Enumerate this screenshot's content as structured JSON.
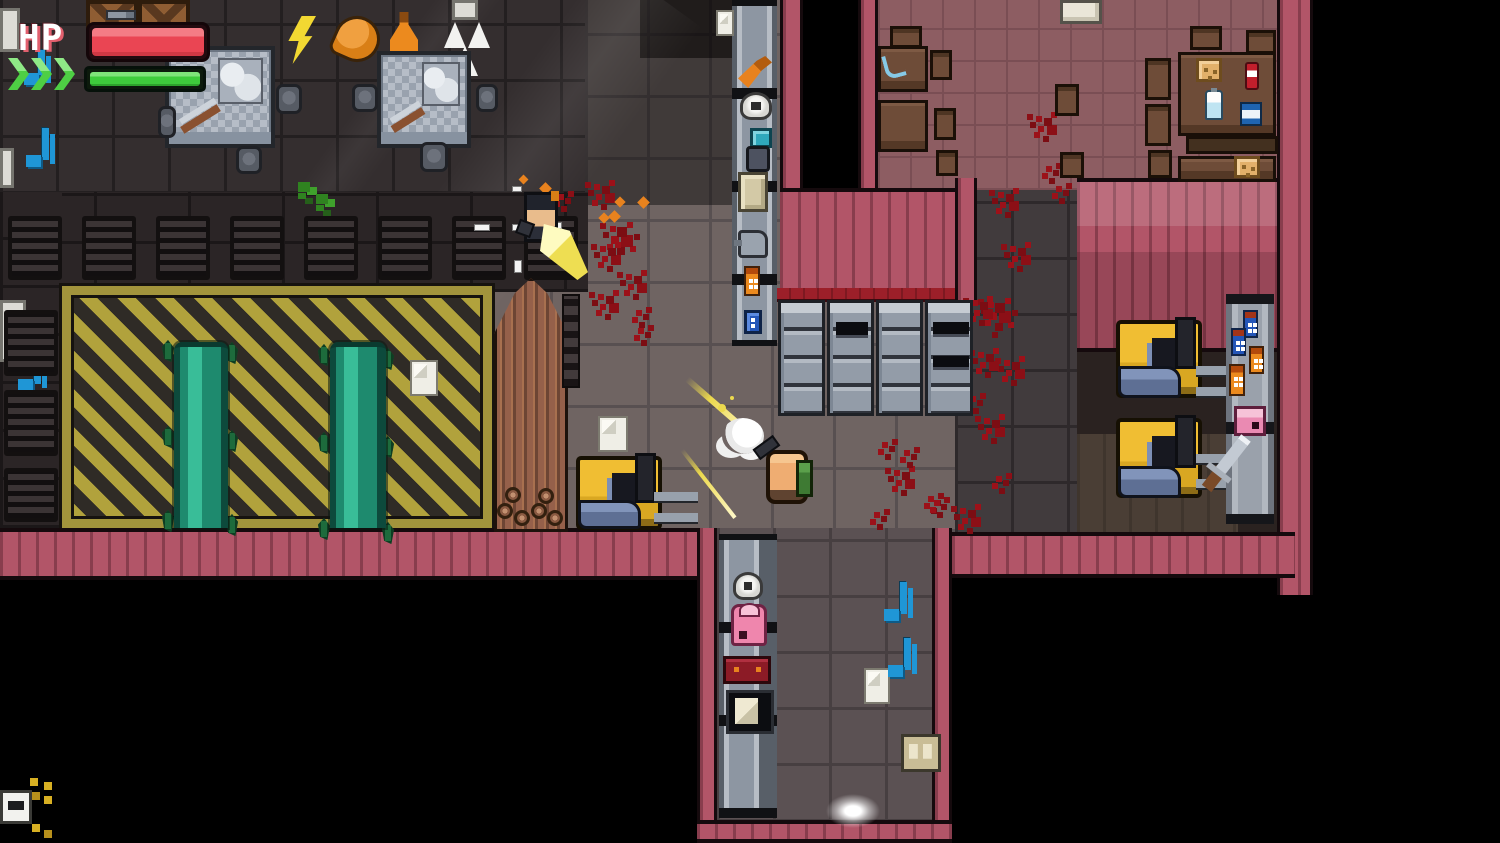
{
  "hud": {
    "hp_label": "HP",
    "hp_percent": 100,
    "boost_percent": 100,
    "chevron_count": 3,
    "hp_color": "#ea4553",
    "boost_color": "#3ecb3c"
  },
  "palette": {
    "wall_pink": "#b25568",
    "hazard_yellow": "#b1a23c",
    "floor_warehouse": "#6f6462",
    "floor_factory": "#342e2f",
    "floor_cafeteria": "#8d5d62",
    "conveyor_teal": "#1e8a6e",
    "forklift_yellow": "#f0be33",
    "blood_red": "#9c1119",
    "void_black": "#000000"
  },
  "scene": {
    "entities": [
      {
        "t": "crate",
        "x": 86,
        "y": 0,
        "w": 52,
        "h": 42
      },
      {
        "t": "crate",
        "x": 138,
        "y": 0,
        "w": 52,
        "h": 42
      },
      {
        "t": "whitepart",
        "x": 0,
        "y": 8,
        "w": 20,
        "h": 44
      },
      {
        "t": "whitepart",
        "x": 0,
        "y": 148,
        "w": 14,
        "h": 40
      },
      {
        "t": "whitepart",
        "x": 0,
        "y": 300,
        "w": 26,
        "h": 62
      },
      {
        "t": "whitepart",
        "x": 452,
        "y": 0,
        "w": 26,
        "h": 20
      },
      {
        "t": "lightning",
        "x": 286,
        "y": 16,
        "w": 30,
        "h": 48
      },
      {
        "t": "drumstick",
        "x": 334,
        "y": 16,
        "w": 46,
        "h": 46,
        "r": 24
      },
      {
        "t": "flask",
        "x": 390,
        "y": 12,
        "w": 28,
        "h": 48
      },
      {
        "t": "tri-white",
        "x": 444,
        "y": 22,
        "w": 22,
        "h": 26
      },
      {
        "t": "tri-white",
        "x": 468,
        "y": 22,
        "w": 22,
        "h": 26
      },
      {
        "t": "tri-white",
        "x": 452,
        "y": 46,
        "w": 26,
        "h": 30
      },
      {
        "t": "bench",
        "x": 165,
        "y": 46,
        "w": 110,
        "h": 102
      },
      {
        "t": "bench",
        "x": 377,
        "y": 51,
        "w": 94,
        "h": 97
      },
      {
        "t": "stool",
        "x": 276,
        "y": 84,
        "w": 26,
        "h": 30
      },
      {
        "t": "stool",
        "x": 236,
        "y": 146,
        "w": 26,
        "h": 28
      },
      {
        "t": "stool",
        "x": 352,
        "y": 84,
        "w": 26,
        "h": 28
      },
      {
        "t": "stool",
        "x": 420,
        "y": 142,
        "w": 28,
        "h": 30
      },
      {
        "t": "stool",
        "x": 476,
        "y": 84,
        "w": 22,
        "h": 28
      },
      {
        "t": "stool",
        "x": 158,
        "y": 106,
        "w": 18,
        "h": 32
      },
      {
        "t": "green-slime",
        "x": 298,
        "y": 182,
        "w": 12,
        "h": 10
      },
      {
        "t": "green-slime",
        "x": 316,
        "y": 194,
        "w": 12,
        "h": 10
      },
      {
        "t": "paper",
        "x": 716,
        "y": 10,
        "w": 18,
        "h": 26
      },
      {
        "t": "music-note",
        "x": 26,
        "y": 128,
        "w": 26,
        "h": 44
      },
      {
        "t": "music-note",
        "x": 18,
        "y": 352,
        "w": 26,
        "h": 44
      },
      {
        "t": "music-note",
        "x": 24,
        "y": 50,
        "w": 24,
        "h": 40
      },
      {
        "t": "vent",
        "x": 8,
        "y": 216,
        "w": 54,
        "h": 64
      },
      {
        "t": "vent",
        "x": 82,
        "y": 216,
        "w": 54,
        "h": 64
      },
      {
        "t": "vent",
        "x": 156,
        "y": 216,
        "w": 54,
        "h": 64
      },
      {
        "t": "vent",
        "x": 230,
        "y": 216,
        "w": 54,
        "h": 64
      },
      {
        "t": "vent",
        "x": 304,
        "y": 216,
        "w": 54,
        "h": 64
      },
      {
        "t": "vent",
        "x": 378,
        "y": 216,
        "w": 54,
        "h": 64
      },
      {
        "t": "vent",
        "x": 452,
        "y": 216,
        "w": 54,
        "h": 64
      },
      {
        "t": "vent",
        "x": 524,
        "y": 216,
        "w": 54,
        "h": 64
      },
      {
        "t": "vent",
        "x": 4,
        "y": 310,
        "w": 54,
        "h": 66
      },
      {
        "t": "vent",
        "x": 4,
        "y": 390,
        "w": 54,
        "h": 66
      },
      {
        "t": "vent",
        "x": 4,
        "y": 468,
        "w": 54,
        "h": 54
      },
      {
        "t": "sprout",
        "x": 162,
        "y": 340,
        "w": 12,
        "h": 22
      },
      {
        "t": "sprout",
        "x": 162,
        "y": 426,
        "w": 12,
        "h": 22
      },
      {
        "t": "sprout",
        "x": 162,
        "y": 510,
        "w": 12,
        "h": 22
      },
      {
        "t": "sprout",
        "x": 226,
        "y": 342,
        "w": 12,
        "h": 22
      },
      {
        "t": "sprout",
        "x": 226,
        "y": 430,
        "w": 12,
        "h": 22
      },
      {
        "t": "sprout",
        "x": 226,
        "y": 514,
        "w": 12,
        "h": 22
      },
      {
        "t": "sprout",
        "x": 318,
        "y": 344,
        "w": 12,
        "h": 22
      },
      {
        "t": "sprout",
        "x": 318,
        "y": 432,
        "w": 12,
        "h": 22
      },
      {
        "t": "sprout",
        "x": 318,
        "y": 518,
        "w": 12,
        "h": 22
      },
      {
        "t": "sprout",
        "x": 382,
        "y": 348,
        "w": 12,
        "h": 22
      },
      {
        "t": "sprout",
        "x": 382,
        "y": 436,
        "w": 12,
        "h": 22
      },
      {
        "t": "sprout",
        "x": 382,
        "y": 522,
        "w": 12,
        "h": 22
      },
      {
        "t": "conveyor-teal",
        "x": 174,
        "y": 342,
        "w": 54,
        "h": 186
      },
      {
        "t": "conveyor-teal",
        "x": 330,
        "y": 342,
        "w": 56,
        "h": 186
      },
      {
        "t": "paper",
        "x": 410,
        "y": 360,
        "w": 28,
        "h": 36
      },
      {
        "t": "woodpile",
        "x": 494,
        "y": 278,
        "w": 74,
        "h": 254
      },
      {
        "t": "ladder",
        "x": 562,
        "y": 294,
        "w": 18,
        "h": 94
      },
      {
        "t": "logend",
        "x": 497,
        "y": 503,
        "w": 16,
        "h": 16
      },
      {
        "t": "logend",
        "x": 514,
        "y": 510,
        "w": 16,
        "h": 16
      },
      {
        "t": "logend",
        "x": 531,
        "y": 503,
        "w": 16,
        "h": 16
      },
      {
        "t": "logend",
        "x": 547,
        "y": 510,
        "w": 16,
        "h": 16
      },
      {
        "t": "logend",
        "x": 505,
        "y": 487,
        "w": 16,
        "h": 16
      },
      {
        "t": "logend",
        "x": 538,
        "y": 488,
        "w": 16,
        "h": 16
      },
      {
        "t": "paper",
        "x": 598,
        "y": 416,
        "w": 30,
        "h": 36
      },
      {
        "t": "blood-m",
        "x": 594,
        "y": 184,
        "w": 6,
        "h": 6
      },
      {
        "t": "blood-l",
        "x": 610,
        "y": 226,
        "w": 6,
        "h": 6
      },
      {
        "t": "blood-m",
        "x": 600,
        "y": 246,
        "w": 6,
        "h": 6
      },
      {
        "t": "blood-m",
        "x": 626,
        "y": 274,
        "w": 6,
        "h": 6
      },
      {
        "t": "blood-s",
        "x": 636,
        "y": 310,
        "w": 6,
        "h": 6
      },
      {
        "t": "blood-s",
        "x": 558,
        "y": 194,
        "w": 6,
        "h": 6
      },
      {
        "t": "blood-m",
        "x": 598,
        "y": 294,
        "w": 6,
        "h": 6
      },
      {
        "t": "blood-s",
        "x": 638,
        "y": 328,
        "w": 6,
        "h": 6
      },
      {
        "t": "blood-m",
        "x": 998,
        "y": 192,
        "w": 6,
        "h": 6
      },
      {
        "t": "blood-m",
        "x": 1010,
        "y": 246,
        "w": 6,
        "h": 6
      },
      {
        "t": "blood-l",
        "x": 988,
        "y": 302,
        "w": 6,
        "h": 6
      },
      {
        "t": "blood-m",
        "x": 1004,
        "y": 360,
        "w": 6,
        "h": 6
      },
      {
        "t": "blood-m",
        "x": 984,
        "y": 418,
        "w": 6,
        "h": 6
      },
      {
        "t": "blood-s",
        "x": 996,
        "y": 476,
        "w": 6,
        "h": 6
      },
      {
        "t": "blood-m",
        "x": 960,
        "y": 508,
        "w": 6,
        "h": 6
      },
      {
        "t": "blood-m",
        "x": 1036,
        "y": 116,
        "w": 6,
        "h": 6
      },
      {
        "t": "blood-s",
        "x": 1046,
        "y": 166,
        "w": 6,
        "h": 6
      },
      {
        "t": "blood-s",
        "x": 1056,
        "y": 186,
        "w": 6,
        "h": 6
      },
      {
        "t": "blood-m",
        "x": 972,
        "y": 300,
        "w": 6,
        "h": 6
      },
      {
        "t": "blood-m",
        "x": 978,
        "y": 352,
        "w": 6,
        "h": 6
      },
      {
        "t": "blood-s",
        "x": 970,
        "y": 396,
        "w": 6,
        "h": 6
      },
      {
        "t": "blood-s",
        "x": 882,
        "y": 442,
        "w": 6,
        "h": 6
      },
      {
        "t": "blood-m",
        "x": 894,
        "y": 470,
        "w": 6,
        "h": 6
      },
      {
        "t": "blood-s",
        "x": 874,
        "y": 512,
        "w": 6,
        "h": 6
      },
      {
        "t": "blood-s",
        "x": 904,
        "y": 450,
        "w": 6,
        "h": 6
      },
      {
        "t": "blood-s",
        "x": 928,
        "y": 496,
        "w": 6,
        "h": 6
      },
      {
        "t": "blood-s",
        "x": 934,
        "y": 500,
        "w": 6,
        "h": 6
      },
      {
        "t": "locker-col",
        "x": 778,
        "y": 300,
        "w": 47,
        "h": 116
      },
      {
        "t": "locker-col",
        "x": 827,
        "y": 300,
        "w": 47,
        "h": 116
      },
      {
        "t": "locker-col",
        "x": 876,
        "y": 300,
        "w": 47,
        "h": 116
      },
      {
        "t": "locker-col",
        "x": 925,
        "y": 300,
        "w": 48,
        "h": 116
      },
      {
        "t": "locker-open",
        "x": 836,
        "y": 322,
        "w": 32,
        "h": 16
      },
      {
        "t": "locker-open",
        "x": 933,
        "y": 322,
        "w": 36,
        "h": 15
      },
      {
        "t": "locker-open",
        "x": 933,
        "y": 356,
        "w": 36,
        "h": 14
      },
      {
        "t": "forklift",
        "x": 576,
        "y": 456,
        "w": 86,
        "h": 74
      },
      {
        "t": "forkbars",
        "x": 654,
        "y": 492,
        "w": 44,
        "h": 30
      },
      {
        "t": "forklift",
        "x": 1116,
        "y": 320,
        "w": 86,
        "h": 78
      },
      {
        "t": "forkbars",
        "x": 1196,
        "y": 366,
        "w": 54,
        "h": 30
      },
      {
        "t": "forklift",
        "x": 1116,
        "y": 418,
        "w": 86,
        "h": 80
      },
      {
        "t": "forkbars",
        "x": 1196,
        "y": 454,
        "w": 54,
        "h": 34
      },
      {
        "t": "citem-tool",
        "x": 738,
        "y": 56,
        "w": 34,
        "h": 32
      },
      {
        "t": "citem-helmet",
        "x": 740,
        "y": 92,
        "w": 32,
        "h": 28
      },
      {
        "t": "citem-teal",
        "x": 750,
        "y": 128,
        "w": 22,
        "h": 20
      },
      {
        "t": "citem-seat",
        "x": 746,
        "y": 146,
        "w": 24,
        "h": 26
      },
      {
        "t": "beige-box",
        "x": 738,
        "y": 172,
        "w": 30,
        "h": 40
      },
      {
        "t": "citem-can",
        "x": 738,
        "y": 230,
        "w": 30,
        "h": 28
      },
      {
        "t": "bottle-orange",
        "x": 744,
        "y": 266,
        "w": 16,
        "h": 30
      },
      {
        "t": "citem-bluebox",
        "x": 744,
        "y": 310,
        "w": 18,
        "h": 24
      },
      {
        "t": "whitebox",
        "x": 1060,
        "y": 0,
        "w": 42,
        "h": 24
      },
      {
        "t": "table-small",
        "x": 878,
        "y": 46,
        "w": 50,
        "h": 46
      },
      {
        "t": "table-small",
        "x": 878,
        "y": 100,
        "w": 50,
        "h": 52
      },
      {
        "t": "knife-mark",
        "x": 884,
        "y": 54,
        "w": 20,
        "h": 24
      },
      {
        "t": "chair",
        "x": 890,
        "y": 26,
        "w": 32,
        "h": 22
      },
      {
        "t": "chair",
        "x": 930,
        "y": 50,
        "w": 22,
        "h": 30
      },
      {
        "t": "chair",
        "x": 934,
        "y": 108,
        "w": 22,
        "h": 32
      },
      {
        "t": "chair",
        "x": 936,
        "y": 150,
        "w": 22,
        "h": 26
      },
      {
        "t": "chair",
        "x": 1055,
        "y": 84,
        "w": 24,
        "h": 32
      },
      {
        "t": "chair",
        "x": 1060,
        "y": 152,
        "w": 24,
        "h": 26
      },
      {
        "t": "chair",
        "x": 1145,
        "y": 58,
        "w": 26,
        "h": 42
      },
      {
        "t": "chair",
        "x": 1145,
        "y": 104,
        "w": 26,
        "h": 42
      },
      {
        "t": "chair",
        "x": 1148,
        "y": 150,
        "w": 24,
        "h": 28
      },
      {
        "t": "chair",
        "x": 1190,
        "y": 26,
        "w": 32,
        "h": 24
      },
      {
        "t": "chair",
        "x": 1246,
        "y": 30,
        "w": 30,
        "h": 24
      },
      {
        "t": "table-big",
        "x": 1178,
        "y": 52,
        "w": 98,
        "h": 84
      },
      {
        "t": "table-shadow",
        "x": 1186,
        "y": 136,
        "w": 92,
        "h": 18
      },
      {
        "t": "table-small",
        "x": 1178,
        "y": 156,
        "w": 98,
        "h": 26
      },
      {
        "t": "bread",
        "x": 1196,
        "y": 58,
        "w": 26,
        "h": 24
      },
      {
        "t": "ketchup",
        "x": 1245,
        "y": 62,
        "w": 14,
        "h": 28
      },
      {
        "t": "milk",
        "x": 1205,
        "y": 90,
        "w": 18,
        "h": 30
      },
      {
        "t": "bluecan",
        "x": 1240,
        "y": 102,
        "w": 22,
        "h": 24
      },
      {
        "t": "bread",
        "x": 1234,
        "y": 156,
        "w": 26,
        "h": 22
      },
      {
        "t": "rack",
        "x": 1226,
        "y": 294,
        "w": 48,
        "h": 230
      },
      {
        "t": "bottle-blue",
        "x": 1243,
        "y": 310,
        "w": 15,
        "h": 28
      },
      {
        "t": "bottle-blue",
        "x": 1231,
        "y": 328,
        "w": 15,
        "h": 28
      },
      {
        "t": "bottle-orange",
        "x": 1249,
        "y": 346,
        "w": 15,
        "h": 28
      },
      {
        "t": "bottle-orange",
        "x": 1229,
        "y": 364,
        "w": 16,
        "h": 32
      },
      {
        "t": "pinkbox",
        "x": 1234,
        "y": 406,
        "w": 32,
        "h": 30
      },
      {
        "t": "sword",
        "x": 1240,
        "y": 438,
        "w": 12,
        "h": 64,
        "r": 38
      },
      {
        "t": "citem-helmet",
        "x": 733,
        "y": 572,
        "w": 30,
        "h": 28
      },
      {
        "t": "backpack",
        "x": 731,
        "y": 604,
        "w": 36,
        "h": 42
      },
      {
        "t": "redbox",
        "x": 723,
        "y": 656,
        "w": 48,
        "h": 28
      },
      {
        "t": "paperbox",
        "x": 726,
        "y": 690,
        "w": 48,
        "h": 44
      },
      {
        "t": "paper",
        "x": 864,
        "y": 668,
        "w": 26,
        "h": 36
      },
      {
        "t": "beigebox-double",
        "x": 901,
        "y": 734,
        "w": 40,
        "h": 38
      },
      {
        "t": "music-note",
        "x": 884,
        "y": 582,
        "w": 26,
        "h": 44
      },
      {
        "t": "music-note",
        "x": 888,
        "y": 638,
        "w": 26,
        "h": 44
      },
      {
        "t": "glow",
        "x": 826,
        "y": 794,
        "w": 54,
        "h": 34
      },
      {
        "t": "sign",
        "x": 0,
        "y": 790,
        "w": 32,
        "h": 34
      },
      {
        "t": "ydots",
        "x": 30,
        "y": 778,
        "w": 8,
        "h": 8
      },
      {
        "t": "smallgun",
        "x": 106,
        "y": 10,
        "w": 30,
        "h": 10
      },
      {
        "t": "casing",
        "x": 512,
        "y": 186,
        "w": 10,
        "h": 6
      },
      {
        "t": "casing",
        "x": 474,
        "y": 224,
        "w": 16,
        "h": 7
      },
      {
        "t": "casing",
        "x": 512,
        "y": 224,
        "w": 11,
        "h": 7
      },
      {
        "t": "casing",
        "x": 551,
        "y": 222,
        "w": 11,
        "h": 7
      },
      {
        "t": "casing",
        "x": 514,
        "y": 260,
        "w": 8,
        "h": 13
      },
      {
        "t": "spark",
        "x": 541,
        "y": 184,
        "w": 9,
        "h": 9
      },
      {
        "t": "spark",
        "x": 610,
        "y": 212,
        "w": 9,
        "h": 9
      },
      {
        "t": "spark",
        "x": 616,
        "y": 198,
        "w": 8,
        "h": 8
      },
      {
        "t": "spark",
        "x": 639,
        "y": 198,
        "w": 9,
        "h": 9
      },
      {
        "t": "spark",
        "x": 600,
        "y": 214,
        "w": 8,
        "h": 8
      },
      {
        "t": "spark",
        "x": 520,
        "y": 176,
        "w": 7,
        "h": 7
      },
      {
        "t": "enemy",
        "x": 524,
        "y": 192,
        "w": 34,
        "h": 50
      },
      {
        "t": "muzzle-flash",
        "x": 540,
        "y": 224,
        "w": 48,
        "h": 56
      },
      {
        "t": "tracer",
        "x": 687,
        "y": 376,
        "w": 88,
        "h": 6,
        "r": 41
      },
      {
        "t": "tracer-thin",
        "x": 682,
        "y": 448,
        "w": 86,
        "h": 4,
        "r": 52
      },
      {
        "t": "sparkle",
        "x": 718,
        "y": 404,
        "w": 8,
        "h": 8
      },
      {
        "t": "smoke",
        "x": 722,
        "y": 418,
        "w": 42,
        "h": 36
      },
      {
        "t": "player",
        "x": 766,
        "y": 450,
        "w": 42,
        "h": 54
      }
    ]
  }
}
